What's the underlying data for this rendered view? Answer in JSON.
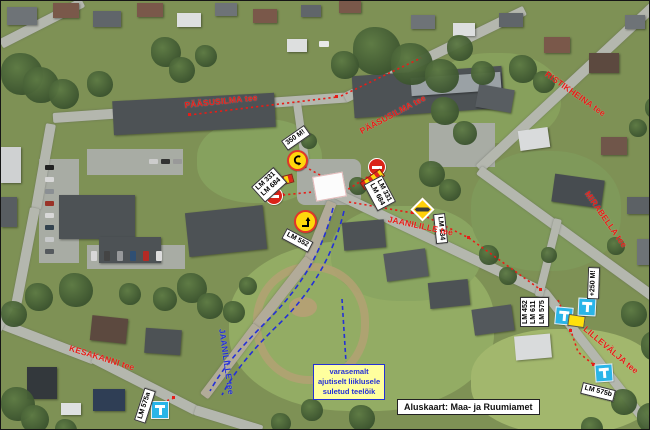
{
  "labels": {
    "paasusilma_h": "PÄÄSUSILMA tee",
    "paasusilma_diag": "PÄÄSUSILMA tee",
    "ristikheina": "RISTIKHEINA tee",
    "mirabella": "MIRABELLA tee",
    "lillevalja": "LILLEVÄLJA tee",
    "kesakanni": "KESAKANNI tee",
    "jaanilille_red": "JAANILILLE tee",
    "jaanilille_blue": "JAANILILLE tee"
  },
  "sign_labels": {
    "dist_350": "350 M!",
    "dist_250": "+250 M!",
    "left_line1": "LM 331",
    "left_line2": "LM 684",
    "right_line1": "LM 331",
    "right_line2": "LM 684",
    "lm552": "LM 552",
    "lm134": "LM 134",
    "cluster_line1": "LM 452",
    "cluster_line2": "LM 611",
    "cluster_line3": "LM 575",
    "lm575a": "LM 575a",
    "lm575b": "LM 575b"
  },
  "note": {
    "line1": "varasemalt",
    "line2": "ajutiselt liiklusele",
    "line3": "suletud teelõik"
  },
  "credit": "Aluskaart: Maa- ja Ruumiamet",
  "colors": {
    "closed_route": "#e71d17",
    "detour_route": "#2430d6",
    "note_bg": "#ffff9e",
    "sign_yellow": "#ffd80c",
    "dead_end_blue": "#2ab5e8"
  }
}
